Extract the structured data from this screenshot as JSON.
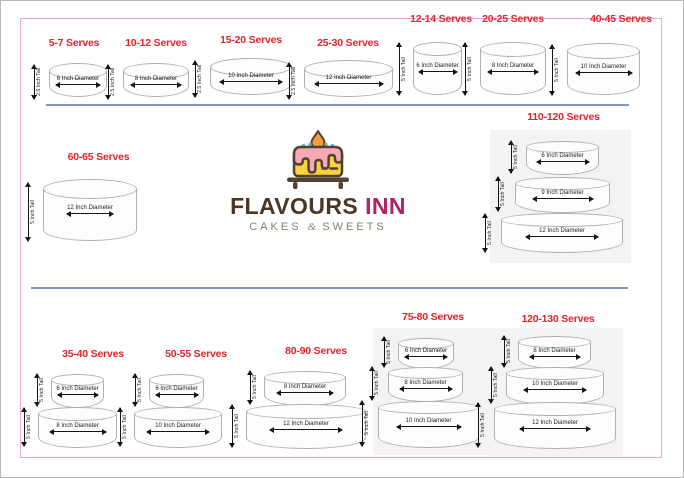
{
  "page": {
    "frame_color": "#eba6de",
    "divider_color": "#7b99bd",
    "heading_color": "#e2232b",
    "panel_color": "#f3f3f3"
  },
  "logo": {
    "brand_primary": "FLAVOURS",
    "brand_secondary": "INN",
    "tagline_left": "CAKES",
    "tagline_amp": "&",
    "tagline_right": "SWEETS",
    "colors": {
      "brand_primary": "#4b3626",
      "brand_secondary": "#b02163",
      "tagline": "#8a7d6e",
      "icing": "#f4a8b8",
      "cake_body": "#f7d33e",
      "flame": "#f59b40",
      "outline": "#53402e",
      "candles": "#5bbcb4"
    }
  },
  "cakes": [
    {
      "serves": "5-7 Serves",
      "tiers": [
        {
          "diameter": "6 Inch Diameter",
          "height": "2.5 Inch Tall"
        }
      ]
    },
    {
      "serves": "10-12 Serves",
      "tiers": [
        {
          "diameter": "8 Inch Diameter",
          "height": "2.5 Inch Tall"
        }
      ]
    },
    {
      "serves": "15-20 Serves",
      "tiers": [
        {
          "diameter": "10 Inch Diameter",
          "height": "2.5 Inch Tall"
        }
      ]
    },
    {
      "serves": "25-30 Serves",
      "tiers": [
        {
          "diameter": "12 Inch Diameter",
          "height": "2.5 Inch Tall"
        }
      ]
    },
    {
      "serves": "12-14 Serves",
      "tiers": [
        {
          "diameter": "6 Inch Diameter",
          "height": "5 Inch Tall"
        }
      ]
    },
    {
      "serves": "20-25 Serves",
      "tiers": [
        {
          "diameter": "8 Inch Diameter",
          "height": "5 Inch Tall"
        }
      ]
    },
    {
      "serves": "40-45 Serves",
      "tiers": [
        {
          "diameter": "10 Inch Diameter",
          "height": "5 Inch Tall"
        }
      ]
    },
    {
      "serves": "60-65 Serves",
      "tiers": [
        {
          "diameter": "12 Inch Diameter",
          "height": "5 Inch Tall"
        }
      ]
    },
    {
      "serves": "110-120 Serves",
      "tiers": [
        {
          "diameter": "6 Inch Diameter",
          "height": "5 Inch Tall"
        },
        {
          "diameter": "9 Inch Diameter",
          "height": "5 Inch Tall"
        },
        {
          "diameter": "12 Inch Diameter",
          "height": "5 Inch Tall"
        }
      ]
    },
    {
      "serves": "35-40 Serves",
      "tiers": [
        {
          "diameter": "6 Inch Diameter",
          "height": "5 Inch Tall"
        },
        {
          "diameter": "8 Inch Diameter",
          "height": "5 Inch Tall"
        }
      ]
    },
    {
      "serves": "50-55 Serves",
      "tiers": [
        {
          "diameter": "6 Inch Diameter",
          "height": "5 Inch Tall"
        },
        {
          "diameter": "10 Inch Diameter",
          "height": "5 Inch Tall"
        }
      ]
    },
    {
      "serves": "80-90 Serves",
      "tiers": [
        {
          "diameter": "8 Inch Diameter",
          "height": "5 Inch Tall"
        },
        {
          "diameter": "12 Inch Diameter",
          "height": "5 Inch Tall"
        }
      ]
    },
    {
      "serves": "75-80 Serves",
      "tiers": [
        {
          "diameter": "6 Inch Diameter",
          "height": "5 Inch Tall"
        },
        {
          "diameter": "8 Inch Diameter",
          "height": "5 Inch Tall"
        },
        {
          "diameter": "10 Inch Diameter",
          "height": "5 Inch Tall"
        }
      ]
    },
    {
      "serves": "120-130 Serves",
      "tiers": [
        {
          "diameter": "8 Inch Diameter",
          "height": "5 Inch Tall"
        },
        {
          "diameter": "10 Inch Diameter",
          "height": "5 Inch Tall"
        },
        {
          "diameter": "12 Inch Diameter",
          "height": "5 Inch Tall"
        }
      ]
    }
  ]
}
